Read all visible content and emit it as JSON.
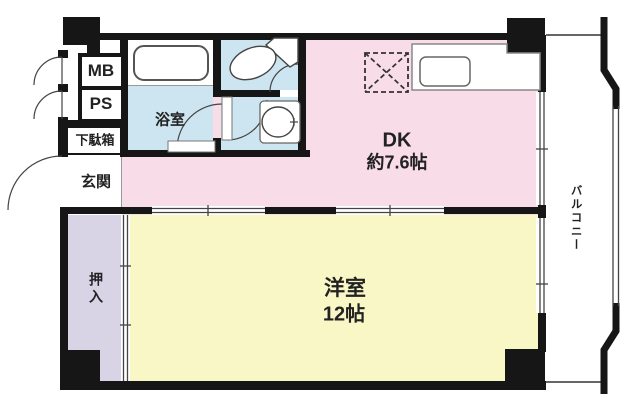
{
  "rooms": {
    "mb": {
      "label": "MB"
    },
    "ps": {
      "label": "PS"
    },
    "shoe_cabinet": {
      "label": "下駄箱"
    },
    "entrance": {
      "label": "玄関"
    },
    "bathroom": {
      "label": "浴室"
    },
    "dining_kitchen": {
      "label": "DK",
      "size": "約7.6帖"
    },
    "western_room": {
      "label": "洋室",
      "size": "12帖"
    },
    "closet": {
      "label": "押入"
    },
    "balcony": {
      "label": "バルコニー"
    }
  },
  "fixtures": {
    "bathtub": "bathtub-icon",
    "toilet": "toilet-icon",
    "washbasin": "washbasin-icon",
    "kitchen_sink": "kitchen-sink-icon",
    "kitchen_counter": "kitchen-counter-icon",
    "refrigerator_space": "refrigerator-space-icon",
    "door_swing": "door-arc-icon",
    "sliding_door": "sliding-door-icon",
    "window": "window-icon",
    "balcony_railing": "railing-icon"
  },
  "colors": {
    "dining_kitchen": "#f8dce7",
    "western_room": "#faf7c6",
    "sanitary": "#cde5f0",
    "closet": "#d8d4e6",
    "wall": "#161616",
    "background": "#ffffff"
  }
}
